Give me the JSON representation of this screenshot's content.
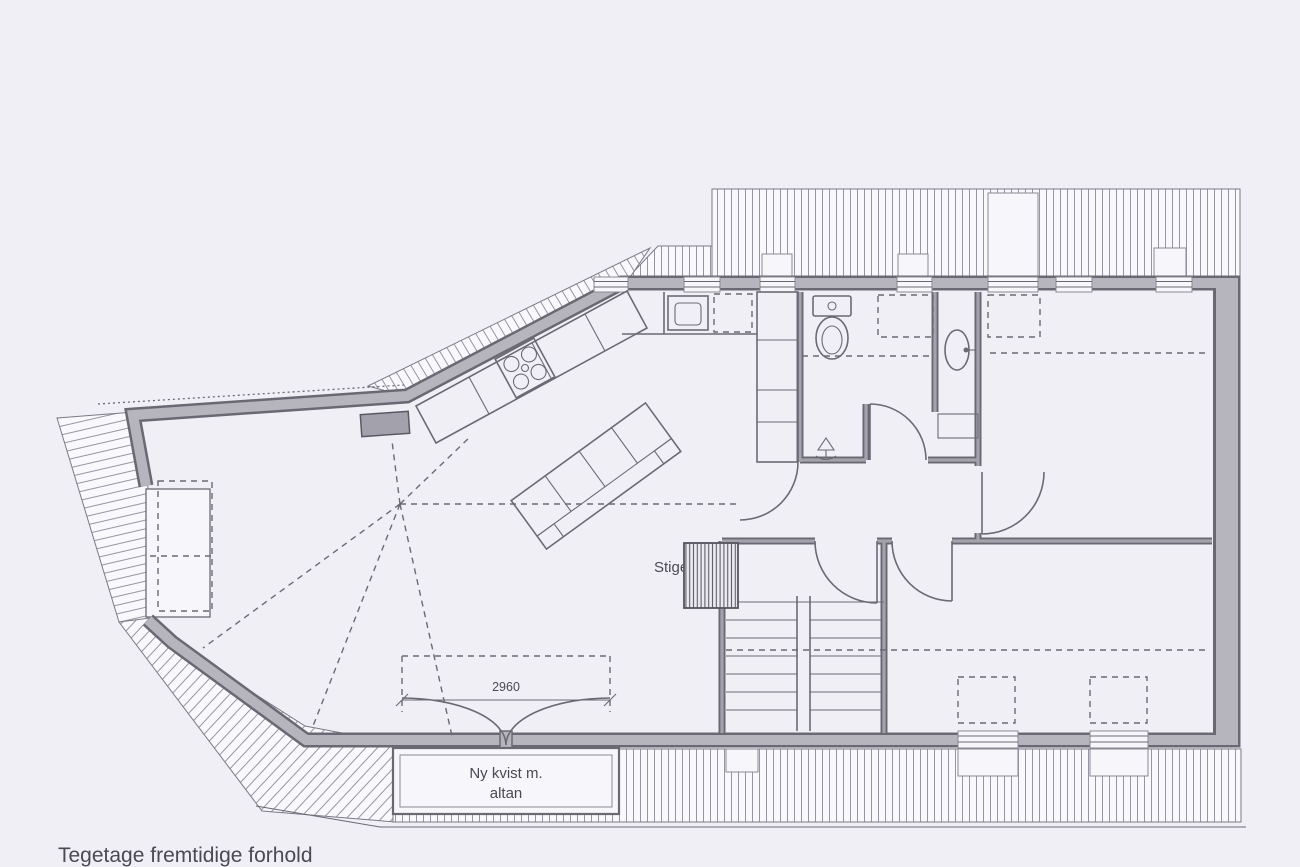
{
  "page": {
    "title": "Tegetage fremtidige forhold",
    "background": "#f1eff6"
  },
  "plan": {
    "type": "attic floor plan (scanned architectural drawing)",
    "dormer": {
      "label_line1": "Ny kvist m.",
      "label_line2": "altan",
      "dimension": "2960"
    },
    "ladder_label": "Stige",
    "colors": {
      "wall_fill": "#b6b5be",
      "wall_edge": "#6a6973",
      "line": "#6b6a74",
      "hatch_line": "#9795a2",
      "text": "#4b4a54"
    }
  },
  "icons": {
    "toilet": "toilet-icon",
    "washbasin": "washbasin-icon",
    "kitchen_sink": "kitchen-sink-icon",
    "stove": "stove-burners-icon",
    "floor_drain": "floor-drain-icon",
    "stairs": "stairs-icon",
    "sofa": "sofa-icon",
    "loft_ladder": "loft-ladder-hatch-icon",
    "door_swing": "door-swing-icon",
    "french_doors": "french-doors-icon",
    "chimney": "chimney-icon"
  }
}
